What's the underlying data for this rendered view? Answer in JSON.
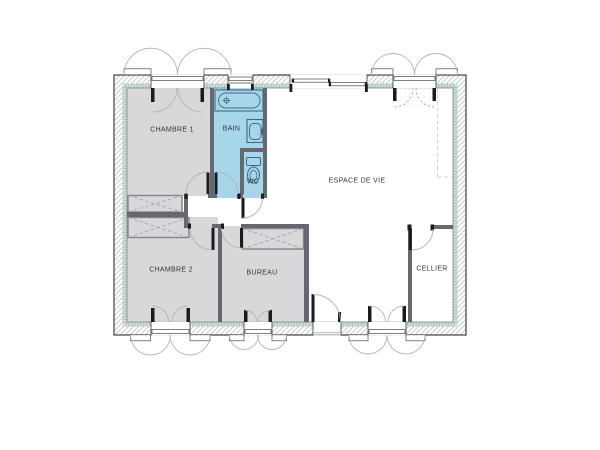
{
  "plan": {
    "type": "house-floor-plan",
    "rooms": {
      "chambre1": {
        "label": "CHAMBRE 1",
        "floor": "gray"
      },
      "bain": {
        "label": "BAIN",
        "floor": "blue"
      },
      "wc": {
        "label": "WC",
        "floor": "blue"
      },
      "espace": {
        "label": "ESPACE DE VIE",
        "floor": "white"
      },
      "chambre2": {
        "label": "CHAMBRE 2",
        "floor": "gray"
      },
      "bureau": {
        "label": "BUREAU",
        "floor": "gray"
      },
      "cellier": {
        "label": "CELLIER",
        "floor": "white"
      }
    },
    "icons": {
      "bathtub": "bathtub-icon",
      "washbasin": "washbasin-icon",
      "toilet": "toilet-icon"
    },
    "features": {
      "closets": 3,
      "interior_doors": 6,
      "entrance_doors": 2,
      "windows": 6
    }
  },
  "colors": {
    "room_gray": "#d8d8da",
    "wet_blue": "#a7d6eb",
    "wall": "#66686f",
    "insulation": "#cfe1dc",
    "insulation_dot": "#a8c8c1",
    "wall_hatch": "#c3c6c9",
    "outline": "#3f4044",
    "fixture": "#41687e",
    "arc": "#b2b4b7",
    "closet": "#83858c",
    "closet_x": "#9da0a4",
    "black": "#1b1b1b",
    "label": "#32353a"
  }
}
